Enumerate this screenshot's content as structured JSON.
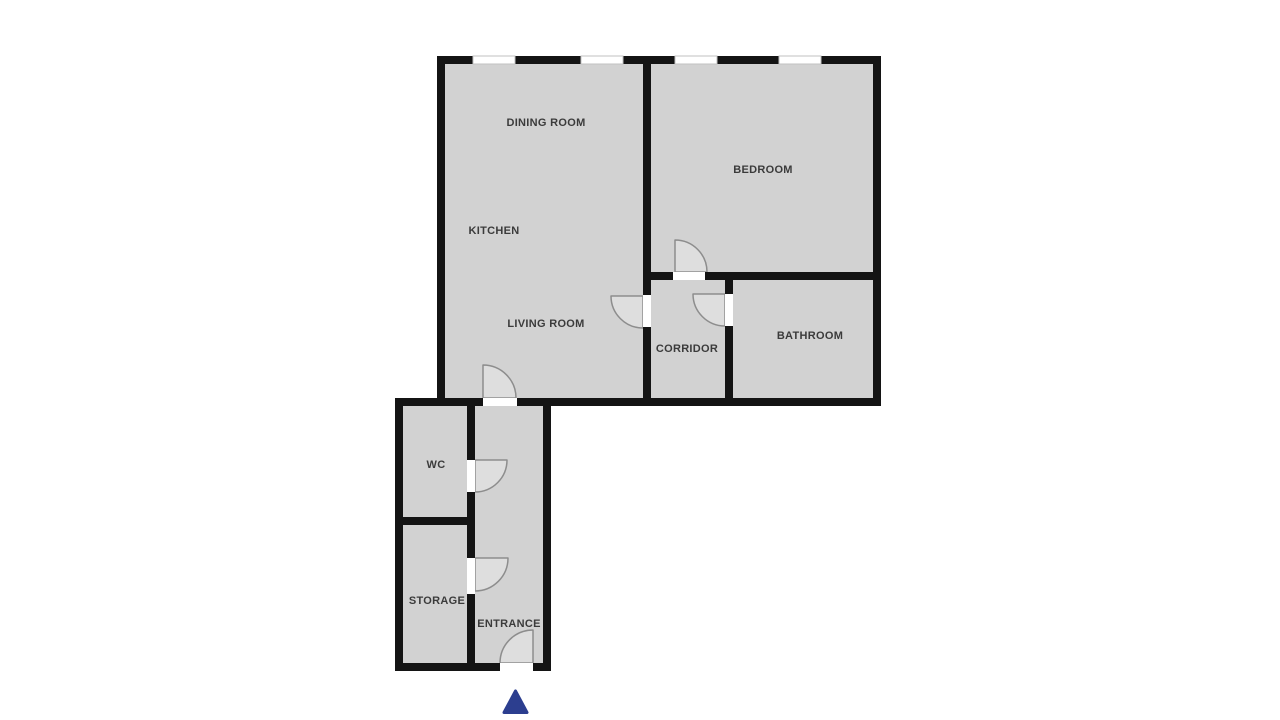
{
  "colors": {
    "background": "#ffffff",
    "floor": "#d2d2d2",
    "wall": "#141414",
    "label": "#3b3b3b",
    "door_arc": "#8d8d8d",
    "door_swing": "#dedede",
    "window_border": "#c2c2c2",
    "entrance_marker": "#2c3e8f"
  },
  "rooms": [
    {
      "id": "dining-room",
      "label": "DINING ROOM"
    },
    {
      "id": "kitchen",
      "label": "KITCHEN"
    },
    {
      "id": "bedroom",
      "label": "BEDROOM"
    },
    {
      "id": "living-room",
      "label": "LIVING ROOM"
    },
    {
      "id": "corridor",
      "label": "CORRIDOR"
    },
    {
      "id": "bathroom",
      "label": "BATHROOM"
    },
    {
      "id": "wc",
      "label": "WC"
    },
    {
      "id": "storage",
      "label": "STORAGE"
    },
    {
      "id": "entrance",
      "label": "ENTRANCE"
    }
  ],
  "doors": [
    "bedroom-door",
    "living-room-corridor-door",
    "bathroom-door",
    "living-room-entrance-hall-door",
    "wc-door",
    "storage-door",
    "entrance-door"
  ],
  "windows": {
    "count": 4,
    "location": "top-exterior-wall"
  },
  "icons": {
    "entrance_marker": "triangle-up"
  }
}
